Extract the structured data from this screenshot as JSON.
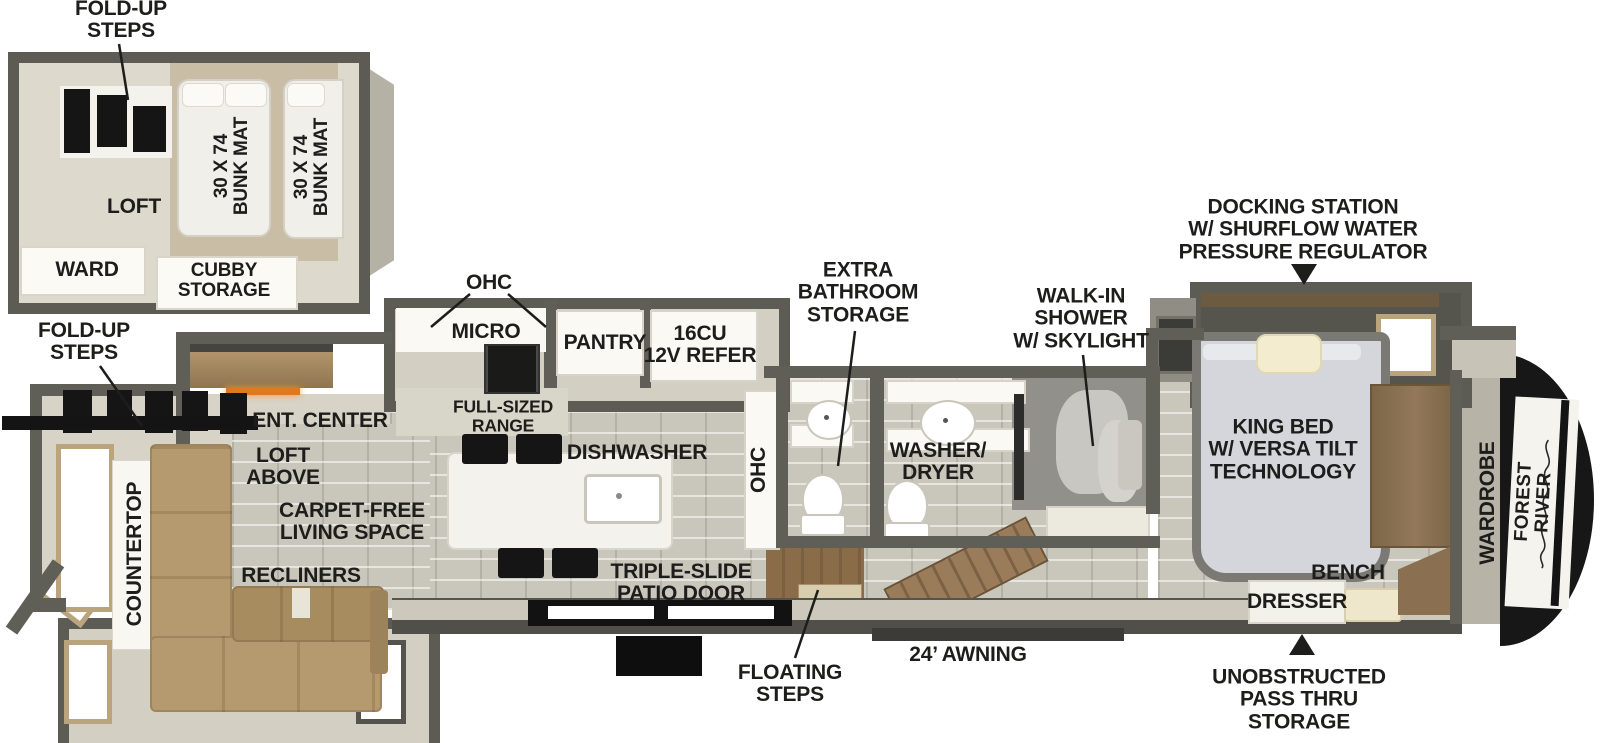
{
  "title": "RV floor plan diagram",
  "brand": {
    "name": "FOREST RIVER"
  },
  "colors": {
    "label_text": "#1d1d1b",
    "wall_gray": "#5c5b54",
    "floor_beige": "#d7d3c6",
    "tile_gray": "#c9c6bb",
    "sofa_tan": "#b59a70",
    "wood_brown": "#8a6c49",
    "fireplace_accent": "#e0791c",
    "fixture_white": "#faf9f4",
    "step_black": "#151515"
  },
  "loft_inset": {
    "fold_up_steps": "FOLD-UP\nSTEPS",
    "loft": "LOFT",
    "bunk_mat_1": "30 X 74\nBUNK MAT",
    "bunk_mat_2": "30 X 74\nBUNK MAT",
    "ward": "WARD",
    "cubby_storage": "CUBBY\nSTORAGE"
  },
  "living": {
    "fold_up_steps": "FOLD-UP\nSTEPS",
    "countertop": "COUNTERTOP",
    "ent_center": "ENT. CENTER",
    "loft_above": "LOFT\nABOVE",
    "carpet_free": "CARPET-FREE\nLIVING SPACE",
    "recliners": "RECLINERS"
  },
  "kitchen": {
    "ohc": "OHC",
    "micro": "MICRO",
    "pantry": "PANTRY",
    "refer": "16CU\n12V REFER",
    "range": "FULL-SIZED\nRANGE",
    "dishwasher": "DISHWASHER",
    "ohc_hall": "OHC"
  },
  "bath": {
    "extra_storage": "EXTRA\nBATHROOM\nSTORAGE",
    "washer_dryer": "WASHER/\nDRYER",
    "walk_in_shower": "WALK-IN\nSHOWER\nW/ SKYLIGHT"
  },
  "bedroom": {
    "docking_station": "DOCKING STATION\nW/ SHURFLOW WATER\nPRESSURE REGULATOR",
    "king_bed": "KING BED\nW/ VERSA TILT\nTECHNOLOGY",
    "wardrobe": "WARDROBE",
    "bench": "BENCH",
    "dresser": "DRESSER",
    "pass_thru": "UNOBSTRUCTED\nPASS THRU\nSTORAGE"
  },
  "exterior": {
    "patio_door": "TRIPLE-SLIDE\nPATIO DOOR",
    "floating_steps": "FLOATING\nSTEPS",
    "awning": "24’ AWNING"
  }
}
